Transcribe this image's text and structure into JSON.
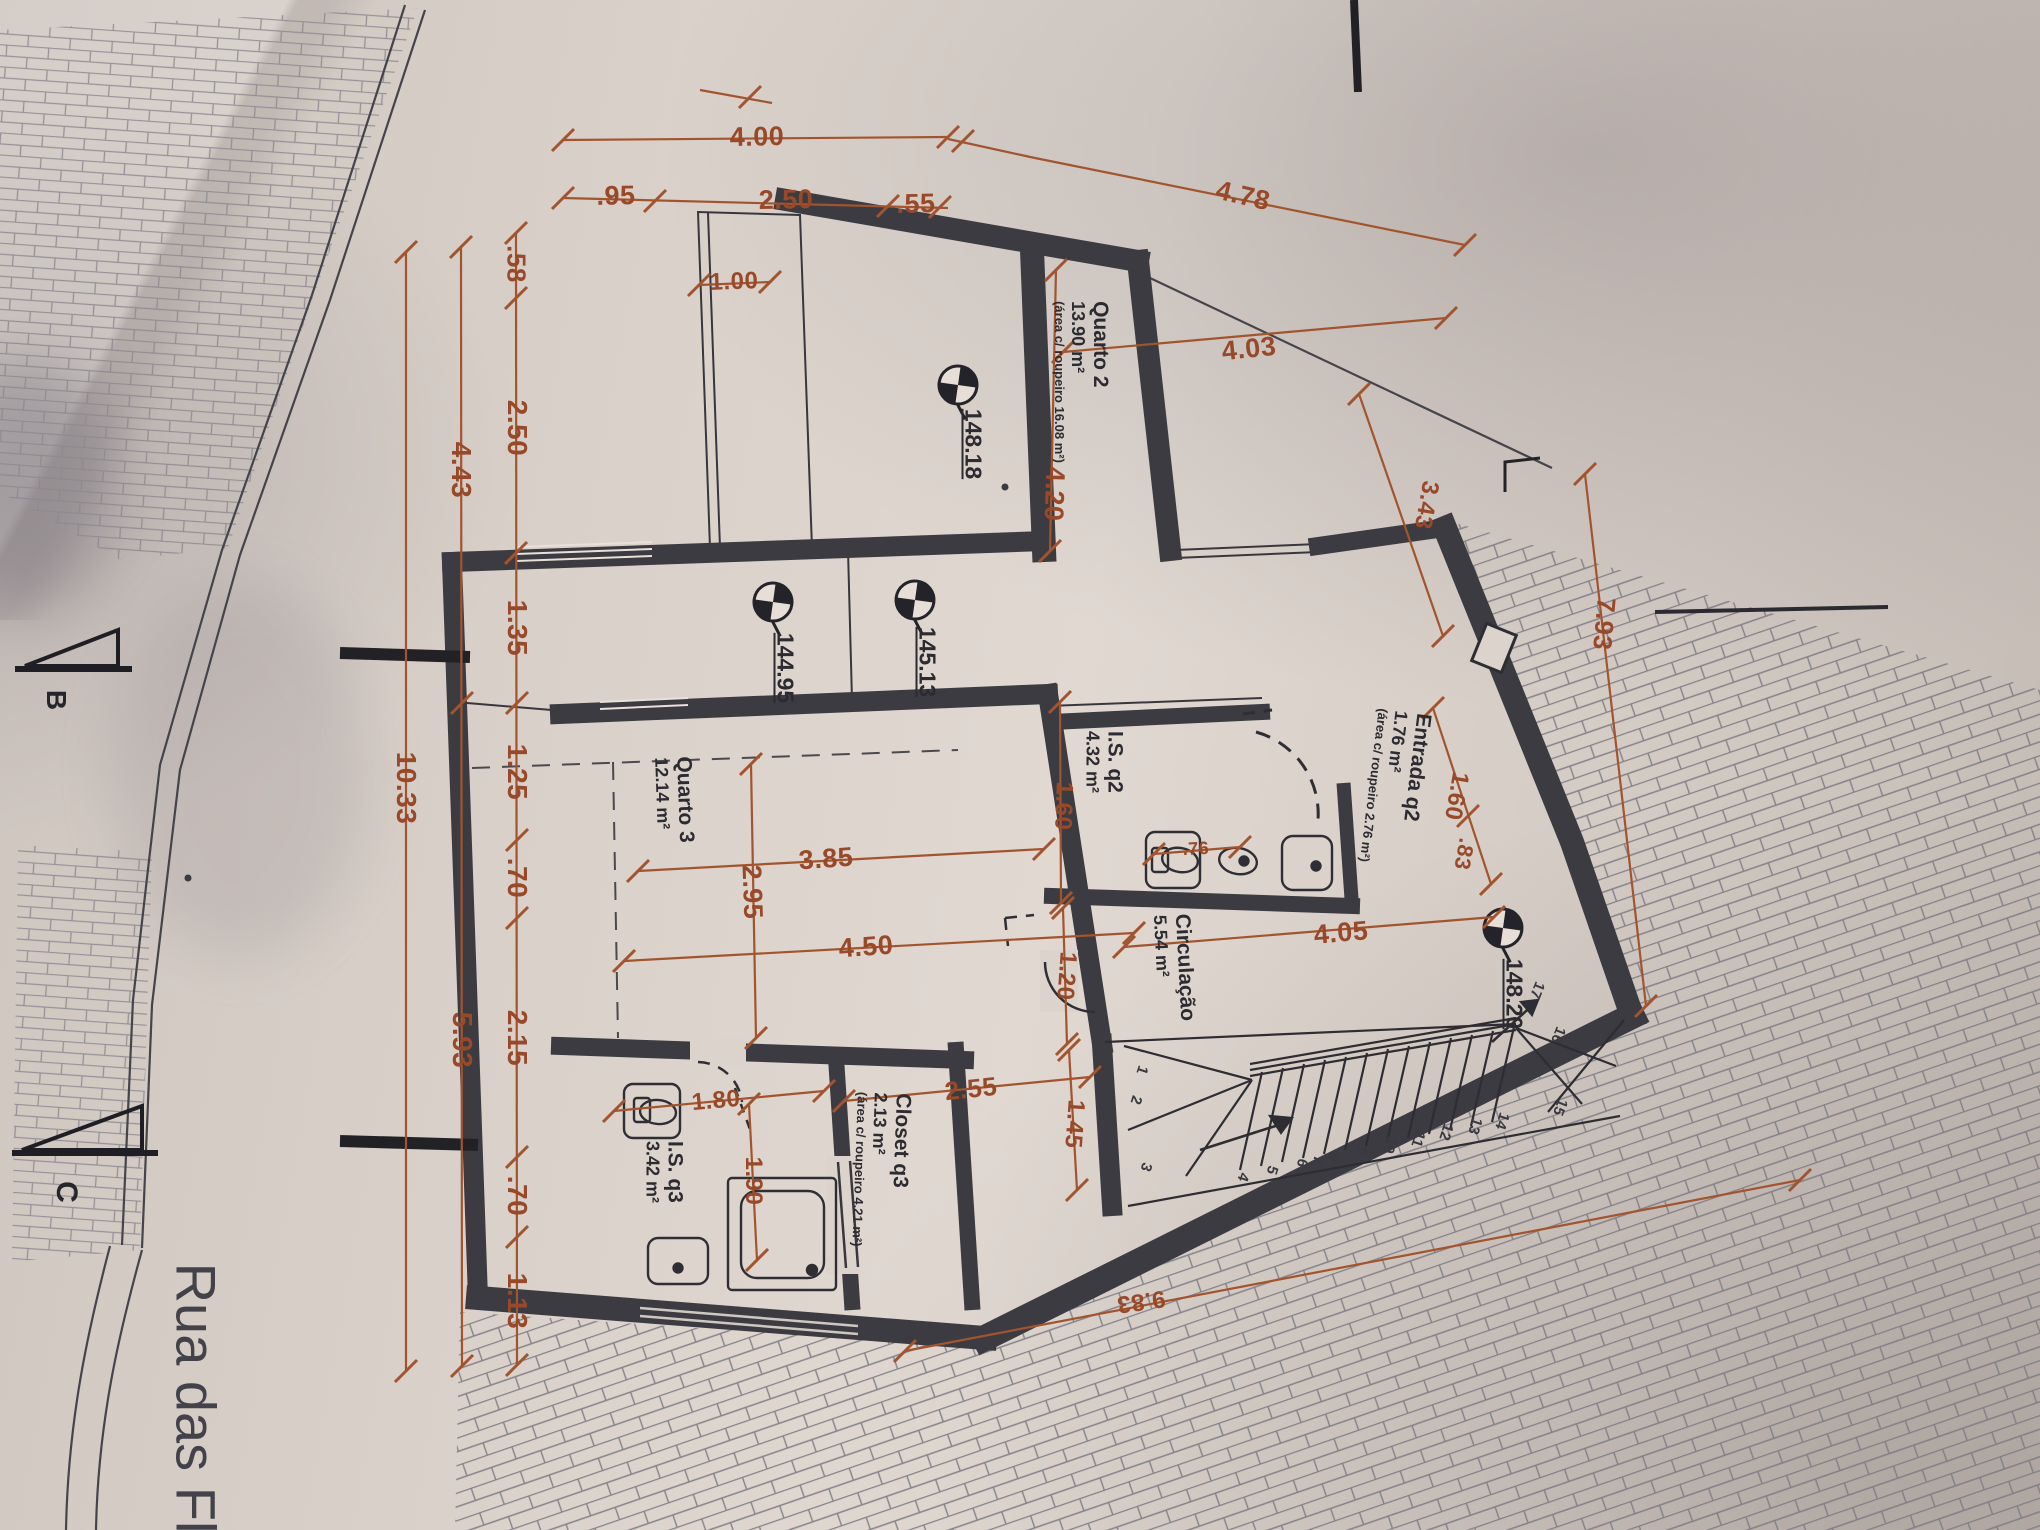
{
  "street_label": "Rua das Fl",
  "section_markers": {
    "b": "B",
    "c": "C"
  },
  "rooms": {
    "quarto2": {
      "name": "Quarto 2",
      "area": "13.90 m²",
      "note": "(área c/ roupeiro 16.08 m²)"
    },
    "entrada": {
      "name": "Entrada q2",
      "area": "1.76 m²",
      "note": "(área c/ roupeiro 2.76 m²)"
    },
    "isq2": {
      "name": "I.S. q2",
      "area": "4.32 m²"
    },
    "quarto3": {
      "name": "Quarto 3",
      "area": "12.14 m²"
    },
    "circulacao": {
      "name": "Circulação",
      "area": "5.54 m²"
    },
    "closet": {
      "name": "Closet q3",
      "area": "2.13 m²",
      "note": "(área c/ roupeiro 4.21 m²)"
    },
    "isq3": {
      "name": "I.S. q3",
      "area": "3.42 m²"
    }
  },
  "levels": {
    "m1": "148.18",
    "m2": "144.95",
    "m3": "145.13",
    "m4": "148.20"
  },
  "dimensions": {
    "top": {
      "d400": "4.00",
      "d095": ".95",
      "d250": "2.50",
      "d055": ".55",
      "d478": "4.78"
    },
    "left": {
      "a058": ".58",
      "a250": "2.50",
      "a135": "1.35",
      "a125": "1.25",
      "a070": ".70",
      "a215": "2.15",
      "a070b": ".70",
      "a113": "1.13",
      "b443": "4.43",
      "b593": "5.93",
      "c1033": "10.33"
    },
    "inner": {
      "w100": "1.00",
      "w403": "4.03",
      "w420": "4.20",
      "w343": "3.43",
      "e160": "1.60",
      "e083": ".83",
      "is160": "1.60",
      "is076": ".76",
      "w385": "3.85",
      "w295": "2.95",
      "w450": "4.50",
      "w120": "1.20",
      "w405": "4.05",
      "w255": "2.55",
      "w145": "1.45",
      "w180": "1.80",
      "w190": "1.90",
      "r793": "7.93",
      "s983": "9.83"
    }
  },
  "stairs": {
    "numbers": [
      "1",
      "2",
      "3",
      "4",
      "5",
      "6",
      "7",
      "8",
      "9",
      "10",
      "11",
      "12",
      "13",
      "14",
      "15",
      "16",
      "17"
    ]
  },
  "colors": {
    "dimension": "#a2542f",
    "wall": "#3c3b41",
    "ink": "#38373d",
    "paper": "#ddd4cd"
  }
}
